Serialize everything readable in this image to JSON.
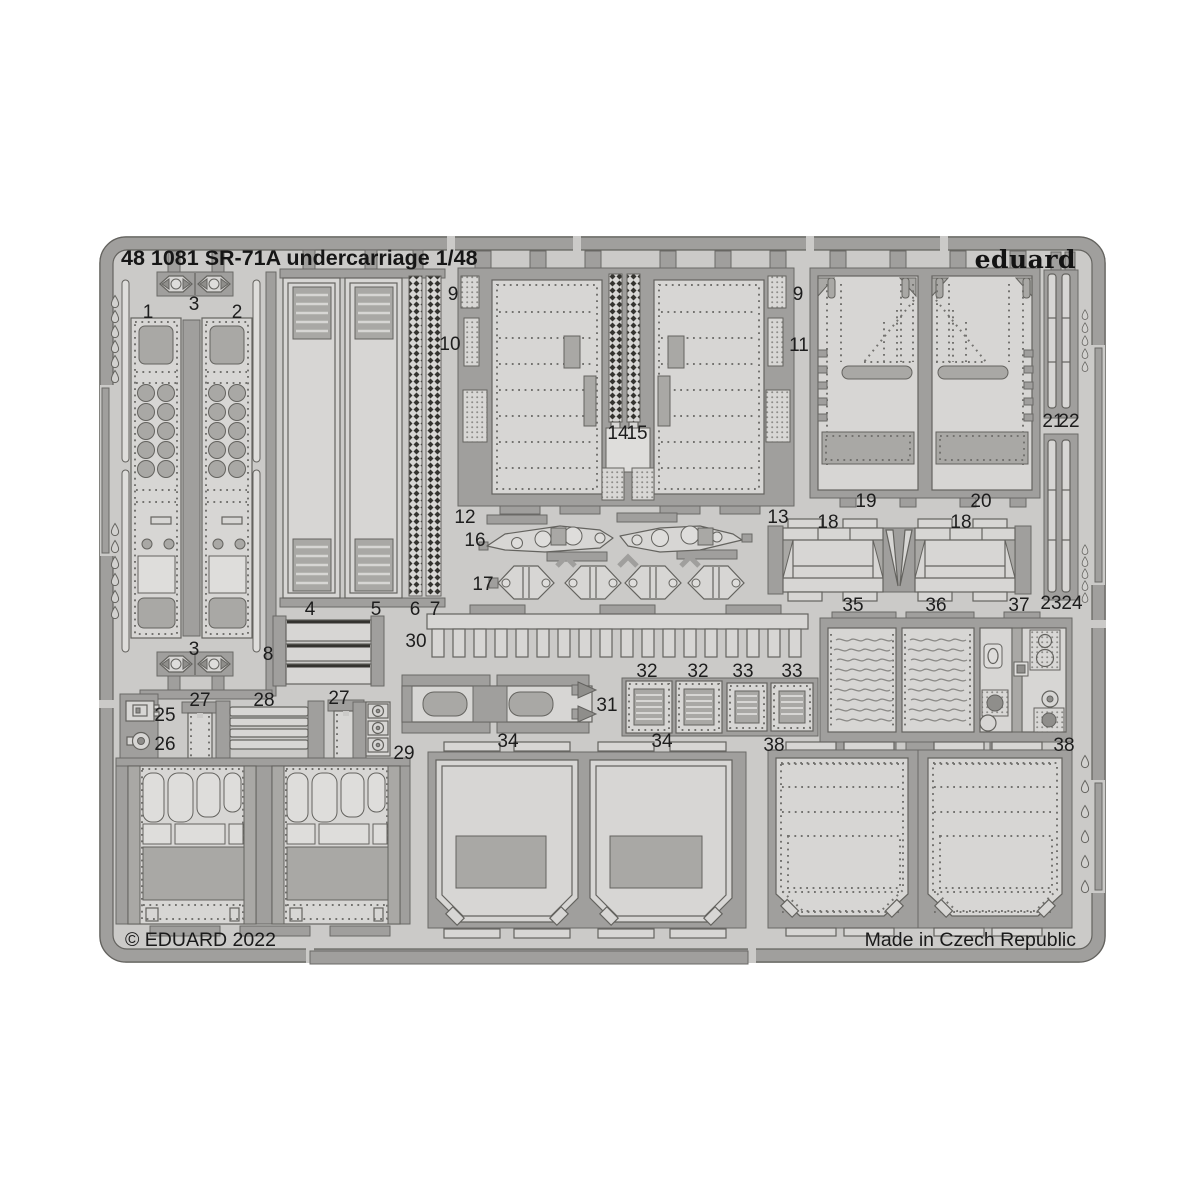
{
  "header": {
    "title": "48 1081 SR-71A undercarriage 1/48",
    "brand": "eduard"
  },
  "footer": {
    "copyright": "© EDUARD 2022",
    "origin": "Made in Czech Republic"
  },
  "fret": {
    "subject": "photo-etched parts sheet",
    "colors": {
      "sheet": "#cbcac8",
      "frame": "#a09f9d",
      "part_light": "#d7d6d4",
      "part_dark": "#a9a8a5",
      "outline": "#64635f",
      "text": "#1a1a1a",
      "backdrop": "#ffffff"
    },
    "part_labels": [
      {
        "n": "3",
        "x": 194,
        "y": 303
      },
      {
        "n": "1",
        "x": 148,
        "y": 311
      },
      {
        "n": "2",
        "x": 237,
        "y": 311
      },
      {
        "n": "3",
        "x": 194,
        "y": 648
      },
      {
        "n": "4",
        "x": 310,
        "y": 608
      },
      {
        "n": "5",
        "x": 376,
        "y": 608
      },
      {
        "n": "6",
        "x": 415,
        "y": 608
      },
      {
        "n": "7",
        "x": 435,
        "y": 608
      },
      {
        "n": "8",
        "x": 268,
        "y": 653
      },
      {
        "n": "9",
        "x": 453,
        "y": 293
      },
      {
        "n": "10",
        "x": 450,
        "y": 343
      },
      {
        "n": "12",
        "x": 465,
        "y": 516
      },
      {
        "n": "14",
        "x": 618,
        "y": 432
      },
      {
        "n": "15",
        "x": 637,
        "y": 432
      },
      {
        "n": "9",
        "x": 798,
        "y": 293
      },
      {
        "n": "11",
        "x": 799,
        "y": 344
      },
      {
        "n": "13",
        "x": 778,
        "y": 516
      },
      {
        "n": "16",
        "x": 475,
        "y": 539
      },
      {
        "n": "17",
        "x": 483,
        "y": 583
      },
      {
        "n": "19",
        "x": 866,
        "y": 500
      },
      {
        "n": "20",
        "x": 981,
        "y": 500
      },
      {
        "n": "18",
        "x": 828,
        "y": 521
      },
      {
        "n": "18",
        "x": 961,
        "y": 521
      },
      {
        "n": "21",
        "x": 1053,
        "y": 420
      },
      {
        "n": "22",
        "x": 1069,
        "y": 420
      },
      {
        "n": "23",
        "x": 1051,
        "y": 602
      },
      {
        "n": "24",
        "x": 1072,
        "y": 602
      },
      {
        "n": "30",
        "x": 416,
        "y": 640
      },
      {
        "n": "31",
        "x": 607,
        "y": 704
      },
      {
        "n": "32",
        "x": 647,
        "y": 670
      },
      {
        "n": "32",
        "x": 698,
        "y": 670
      },
      {
        "n": "33",
        "x": 743,
        "y": 670
      },
      {
        "n": "33",
        "x": 792,
        "y": 670
      },
      {
        "n": "35",
        "x": 853,
        "y": 604
      },
      {
        "n": "36",
        "x": 936,
        "y": 604
      },
      {
        "n": "37",
        "x": 1019,
        "y": 604
      },
      {
        "n": "25",
        "x": 165,
        "y": 714
      },
      {
        "n": "26",
        "x": 165,
        "y": 743
      },
      {
        "n": "27",
        "x": 200,
        "y": 699
      },
      {
        "n": "28",
        "x": 264,
        "y": 699
      },
      {
        "n": "27",
        "x": 339,
        "y": 697
      },
      {
        "n": "29",
        "x": 404,
        "y": 752
      },
      {
        "n": "34",
        "x": 508,
        "y": 740
      },
      {
        "n": "34",
        "x": 662,
        "y": 740
      },
      {
        "n": "38",
        "x": 774,
        "y": 744
      },
      {
        "n": "38",
        "x": 1064,
        "y": 744
      }
    ]
  }
}
